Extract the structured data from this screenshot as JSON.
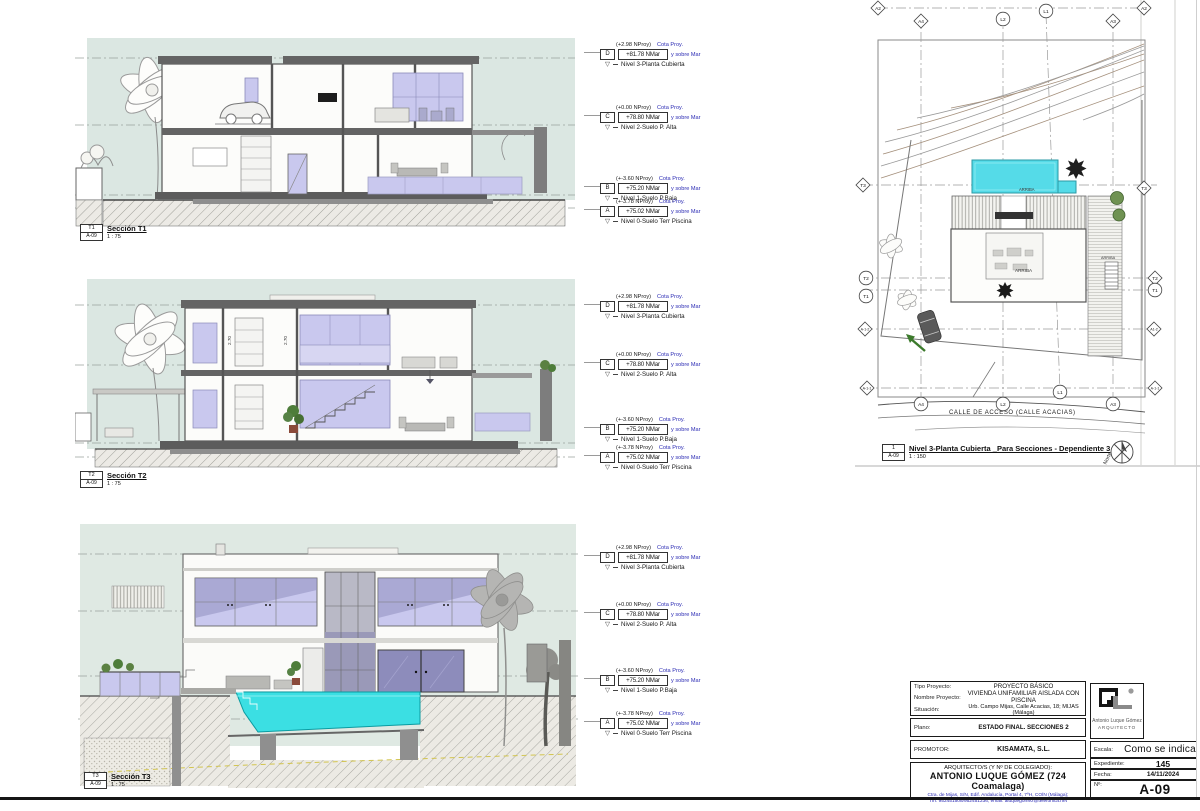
{
  "sheet": {
    "labels": {
      "cota1": "Cota Proy.",
      "cota2": "y sobre Mar"
    },
    "levels": [
      {
        "tag": "D",
        "nproy": "(+2.98 NProy)",
        "nmar": "+81.78 NMar",
        "name": "Nivel 3-Planta Cubierta"
      },
      {
        "tag": "C",
        "nproy": "(+0.00 NProy)",
        "nmar": "+78.80 NMar",
        "name": "Nivel 2-Suelo P. Alta"
      },
      {
        "tag": "B",
        "nproy": "(+-3.60 NProy)",
        "nmar": "+75.20 NMar",
        "name": "Nivel 1-Suelo P.Baja"
      },
      {
        "tag": "A",
        "nproy": "(+-3.78 NProy)",
        "nmar": "+75.02 NMar",
        "name": "Nivel 0-Suelo Terr Piscina"
      }
    ],
    "sections": [
      {
        "num": "T1",
        "ref": "A-09",
        "title": "Sección T1",
        "scale": "1 : 75"
      },
      {
        "num": "T2",
        "ref": "A-09",
        "title": "Sección T2",
        "scale": "1 : 75"
      },
      {
        "num": "T3",
        "ref": "A-09",
        "title": "Sección T3",
        "scale": "1 : 75"
      }
    ],
    "dims": {
      "a": "2.70",
      "b": "2.70"
    },
    "siteplan": {
      "caption": {
        "num": "1",
        "ref": "A-09",
        "title": "Nivel 3-Planta Cubierta _Para Secciones - Dependiente 3",
        "scale": "1 : 150"
      },
      "street": "CALLE DE ACCESO (CALLE ACACIAS)",
      "north": "Norte",
      "arriba": "ARRIBA",
      "grid_top": [
        "A2",
        "A4",
        "L2",
        "L1",
        "A3",
        "A2"
      ],
      "grid_left": [
        "T3",
        "T2",
        "T1",
        "A-1-2",
        "A-1-1"
      ],
      "grid_right": [
        "T3",
        "T2",
        "T1",
        "A1-2",
        "A-1-1"
      ],
      "grid_bottom": [
        "A4",
        "L2",
        "L1",
        "A3"
      ]
    },
    "titleblock": {
      "tipo_label": "Tipo Proyecto:",
      "tipo": "PROYECTO BÁSICO",
      "nombre_label": "Nombre Proyecto:",
      "nombre": "VIVIENDA UNIFAMILIAR AISLADA CON PISCINA",
      "situacion_label": "Situación:",
      "situacion": "Urb. Campo Mijas, Calle Acacias, 18; MIJAS (Málaga)",
      "plano_label": "Plano:",
      "plano": "ESTADO FINAL. SECCIONES 2",
      "promotor_label": "PROMOTOR:",
      "promotor": "KISAMATA, S.L.",
      "arquitecto_label": "ARQUITECTO/S (Y Nº DE COLEGIADO):",
      "arquitecto": "ANTONIO LUQUE GÓMEZ (724 Coamalaga)",
      "contacto1": "Ctra. de Mijas, S/N, Edif. Andalucía, Portal 4, 7ºH, COÍN (Málaga);",
      "contacto2": "Tfn: 952451508/952451236; email: aluquegomez@telefonica.net",
      "escala_label": "Escala:",
      "escala": "Como se indica",
      "expediente_label": "Expediente:",
      "expediente": "145",
      "fecha_label": "Fecha:",
      "fecha": "14/11/2024",
      "num_label": "Nº:",
      "num": "A-09",
      "logo_line1": "Antonio Luque Gómez",
      "logo_line2": "ARQUITECTO"
    },
    "colors": {
      "pool_cyan": "#3bdfe3",
      "glass_lavender": "#c9c8ee",
      "sky": "#dbe7e2",
      "annotation_blue": "#2b2bb4"
    }
  }
}
